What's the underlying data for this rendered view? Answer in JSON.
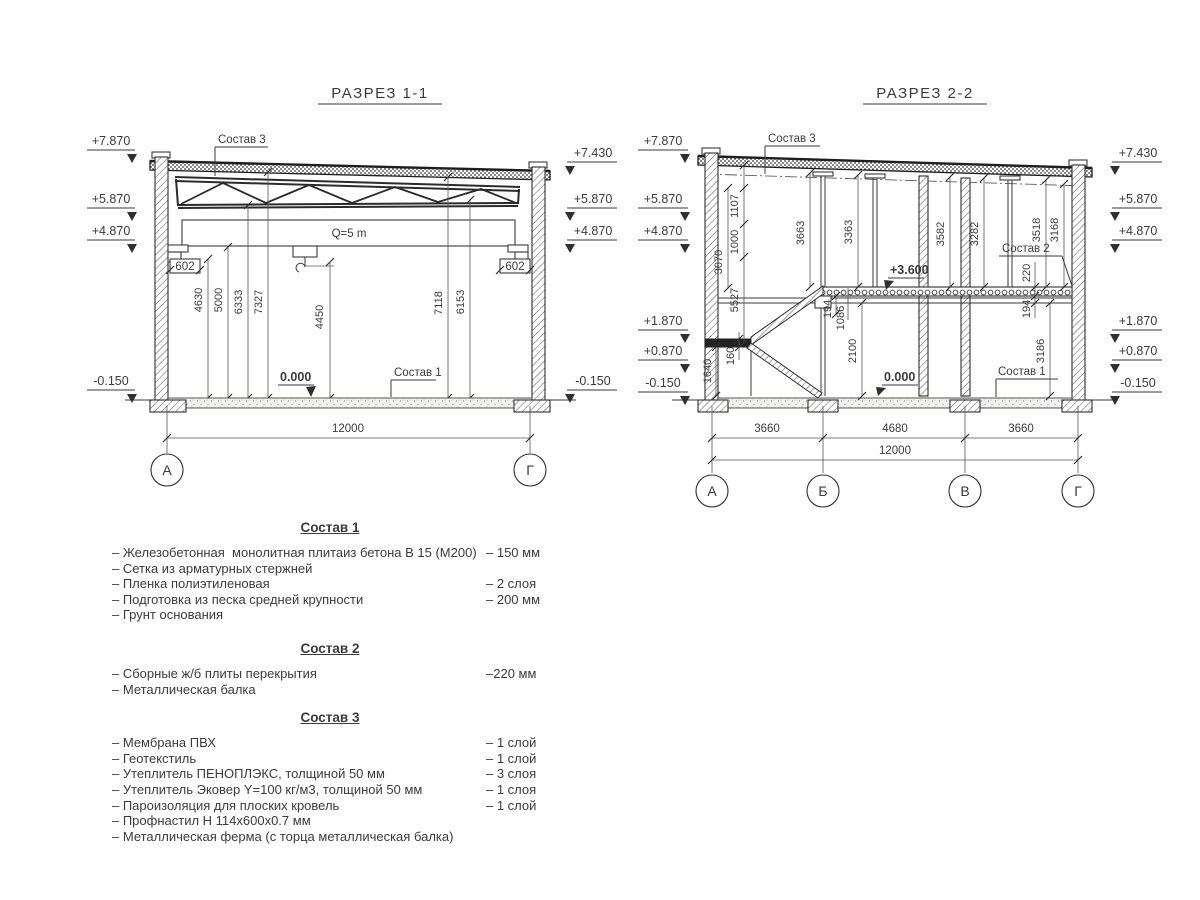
{
  "drawing": {
    "section1": {
      "title": "РАЗРЕЗ 1-1",
      "sostav3_label": "Состав 3",
      "sostav1_label": "Состав 1",
      "crane_label": "Q=5 m",
      "zero_mark": "0.000",
      "left_marks": [
        "+7.870",
        "+5.870",
        "+4.870",
        "-0.150"
      ],
      "right_marks": [
        "+7.430",
        "+5.870",
        "+4.870",
        "-0.150"
      ],
      "corbel_dim_left": "602",
      "corbel_dim_right": "602",
      "vertical_dims": [
        "4630",
        "5000",
        "6333",
        "7327",
        "4450",
        "7118",
        "6153"
      ],
      "span_dim": "12000",
      "axes": [
        "А",
        "Г"
      ]
    },
    "section2": {
      "title": "РАЗРЕЗ 2-2",
      "sostav3_label": "Состав 3",
      "sostav2_label": "Состав 2",
      "sostav1_label": "Состав 1",
      "zero_mark": "0.000",
      "level_mark": "+3.600",
      "left_marks": [
        "+7.870",
        "+5.870",
        "+4.870",
        "+1.870",
        "+0.870",
        "-0.150"
      ],
      "right_marks": [
        "+7.430",
        "+5.870",
        "+4.870",
        "+1.870",
        "+0.870",
        "-0.150"
      ],
      "upper_dims": [
        "3663",
        "3363",
        "3582",
        "3282",
        "3518",
        "3168"
      ],
      "left_chain_dims": [
        "1107",
        "1000",
        "3070",
        "5527"
      ],
      "stair_dims": [
        "1640",
        "160",
        "2100",
        "194",
        "1086"
      ],
      "slab_dims": [
        "220",
        "194",
        "3186"
      ],
      "bay_dims": [
        "3660",
        "4680",
        "3660"
      ],
      "span_dim": "12000",
      "axes": [
        "А",
        "Б",
        "В",
        "Г"
      ]
    }
  },
  "legend": {
    "sostav1": {
      "title": "Состав 1",
      "items": [
        {
          "label": "– Железобетонная  монолитная плитаиз бетона В 15 (М200)",
          "value": "– 150 мм"
        },
        {
          "label": "– Сетка из арматурных стержней",
          "value": ""
        },
        {
          "label": "– Пленка полиэтиленовая",
          "value": "– 2 слоя"
        },
        {
          "label": "– Подготовка из песка средней крупности",
          "value": "– 200 мм"
        },
        {
          "label": "– Грунт основания",
          "value": ""
        }
      ]
    },
    "sostav2": {
      "title": "Состав 2",
      "items": [
        {
          "label": "– Сборные ж/б плиты перекрытия",
          "value": "–220 мм"
        },
        {
          "label": "– Металлическая балка",
          "value": ""
        }
      ]
    },
    "sostav3": {
      "title": "Состав 3",
      "items": [
        {
          "label": "– Мембрана ПВХ",
          "value": "– 1 слой"
        },
        {
          "label": "– Геотекстиль",
          "value": "– 1 слой"
        },
        {
          "label": "– Утеплитель ПЕНОПЛЭКС, толщиной 50 мм",
          "value": "– 3 слоя"
        },
        {
          "label": "– Утеплитель Эковер Y=100 кг/м3, толщиной 50 мм",
          "value": "– 1 слоя"
        },
        {
          "label": "– Пароизоляция для плоских кровель",
          "value": "– 1 слой"
        },
        {
          "label": "– Профнастил Н 114х600х0.7 мм",
          "value": ""
        },
        {
          "label": "– Металлическая ферма (с торца металлическая балка)",
          "value": ""
        }
      ]
    }
  }
}
